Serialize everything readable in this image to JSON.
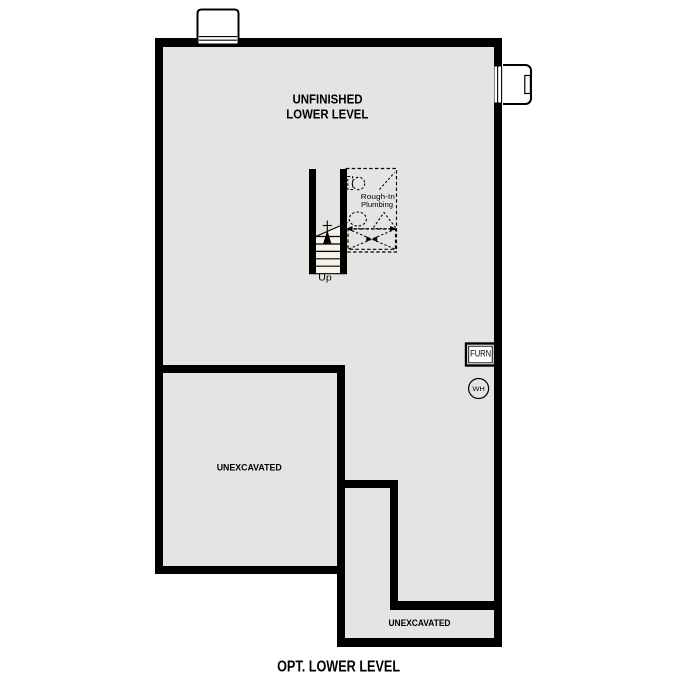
{
  "plan_title": "OPT. LOWER LEVEL",
  "rooms": {
    "main": {
      "label_line1": "UNFINISHED",
      "label_line2": "LOWER LEVEL"
    },
    "unexcavated_left": {
      "label": "UNEXCAVATED"
    },
    "unexcavated_bottom": {
      "label": "UNEXCAVATED"
    }
  },
  "stairs": {
    "direction_label": "Up"
  },
  "plumbing": {
    "label_line1": "Rough-In",
    "label_line2": "Plumbing"
  },
  "equipment": {
    "furnace_label": "FURN",
    "water_heater_label": "WH"
  },
  "colors": {
    "background": "#ffffff",
    "floor": "#e4e4e2",
    "wall": "#000000",
    "line": "#000000",
    "stair_fill": "#f7f2e8"
  }
}
